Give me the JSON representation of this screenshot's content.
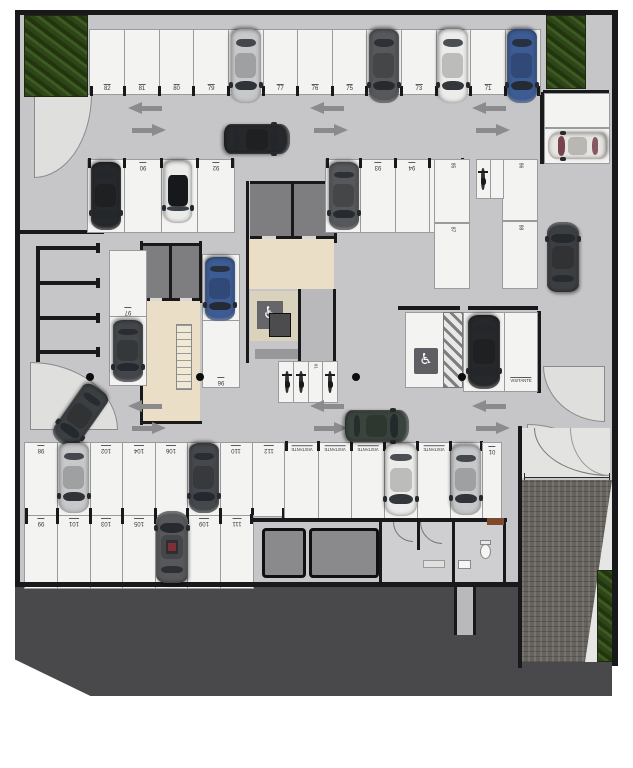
{
  "title": "Underground parking garage floor plan",
  "legend": {
    "visitor": "VISITANTE",
    "accessible_icon": "♿"
  },
  "stall_numbers": {
    "top": [
      "82",
      "81",
      "80",
      "79",
      "",
      "77",
      "76",
      "75",
      "",
      "73",
      "",
      "71",
      ""
    ],
    "mid_left": [
      "",
      "90",
      "",
      "92"
    ],
    "mid_center": [
      "",
      "93",
      "94",
      "95"
    ],
    "right_grid": [
      "85",
      "86",
      "87",
      "88"
    ],
    "left_col": [
      "97",
      ""
    ],
    "core_col": [
      "",
      "96"
    ],
    "moto": [
      "",
      "",
      "01",
      ""
    ],
    "bottom_upper": [
      "98",
      "",
      "102",
      "104",
      "106",
      "",
      "110",
      "112"
    ],
    "bottom_lower": [
      "99",
      "101",
      "103",
      "105",
      "",
      "109",
      "111"
    ],
    "visitor_row": [
      "VISITANTE",
      "VISITANTE",
      "VISITANTE",
      "",
      "VISITANTE",
      ""
    ],
    "visitor_mid": "VISITANTE",
    "narrow": "01"
  },
  "colors": {
    "floor": "#c6c6c8",
    "wall": "#19191b",
    "stall": "#f3f3f1",
    "stall_line": "#9b9b9d",
    "beige": "#eadfc6",
    "beige_light": "#d9d2bd",
    "room_gray": "#7e7e80",
    "band": "#49494b",
    "ramp": "#6f6a66",
    "arrow": "#8b8b8d",
    "curb": "#dfdfdd",
    "cars": {
      "silver": "#c7c8ca",
      "white": "#ececea",
      "pearl": "#e7e5e1",
      "blue": "#3d5c94",
      "black": "#26282b",
      "charcoal": "#3c3f42",
      "darkgray": "#56585b",
      "green": "#3a443d",
      "van": "#43464a",
      "darkslate": "#45484c",
      "glass_maroon": "#6e3540"
    }
  }
}
